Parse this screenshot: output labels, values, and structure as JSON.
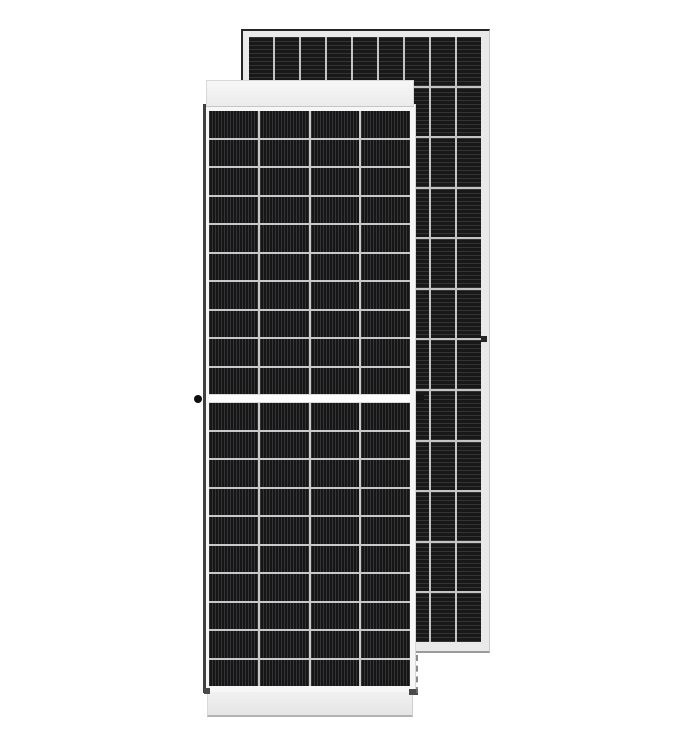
{
  "scene": {
    "type": "product-photo",
    "subject": "Two framed monocrystalline half-cut solar PV modules, front module overlapping rear module, on plain white background",
    "background_color": "#ffffff"
  },
  "front_panel": {
    "label": "front solar module",
    "halves": 2,
    "rows_per_half": 10,
    "columns": 4,
    "cell_color": "#161616",
    "finger_orientation": "vertical",
    "finger_line_color": "#2e2e2e",
    "grid_line_color": "#c9c9c9",
    "frame_color": "#efefef",
    "frame_dark_edge_color": "#404040",
    "center_gap_color": "#fdfdfd",
    "has_left_grounding_hole": true,
    "has_right_grounding_hole": true
  },
  "back_panel": {
    "label": "rear solar module",
    "rows": 12,
    "columns": 9,
    "cell_color": "#181818",
    "finger_orientation": "horizontal",
    "finger_line_color": "#2b2b2b",
    "grid_line_color": "#c4c4c4",
    "frame_color": "#e9e9e9",
    "border_dark_color": "#252525",
    "border_bottom_color": "#9b9b9b",
    "has_right_grounding_hole": true
  }
}
